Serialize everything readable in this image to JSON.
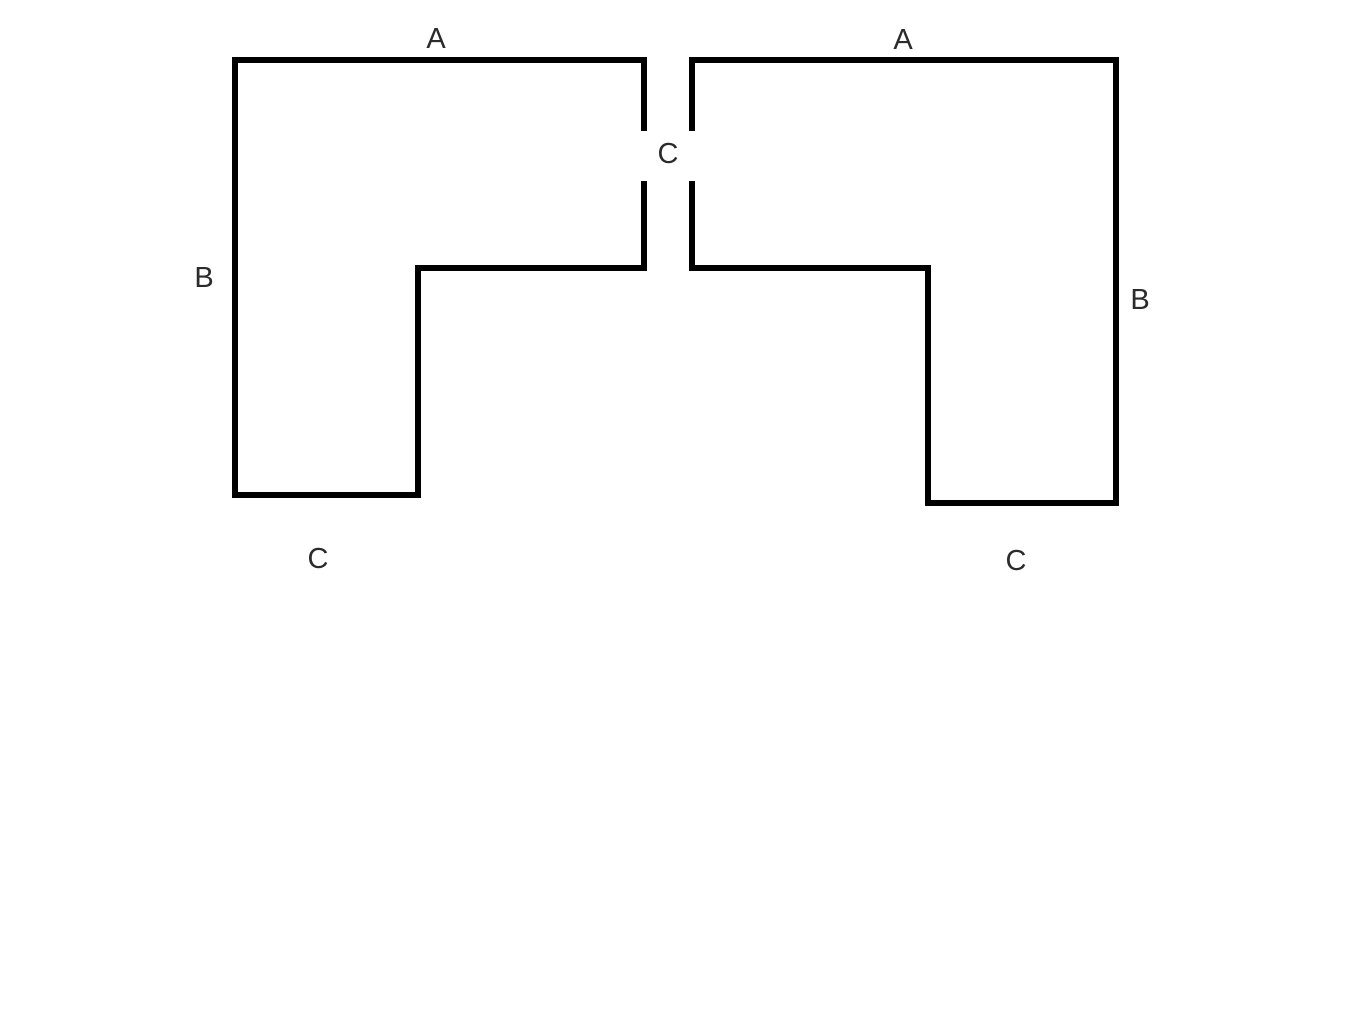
{
  "canvas": {
    "width": 1366,
    "height": 1025,
    "background": "#ffffff"
  },
  "style": {
    "stroke_color": "#000000",
    "stroke_width": 6,
    "label_color": "#2b2b2b",
    "label_font_size": 29
  },
  "shapes": [
    {
      "name": "left-l-shape",
      "points": [
        [
          644,
          131
        ],
        [
          644,
          60
        ],
        [
          235,
          60
        ],
        [
          235,
          495
        ],
        [
          418,
          495
        ],
        [
          418,
          268
        ],
        [
          644,
          268
        ],
        [
          644,
          181
        ]
      ]
    },
    {
      "name": "right-l-shape",
      "points": [
        [
          692,
          131
        ],
        [
          692,
          60
        ],
        [
          1116,
          60
        ],
        [
          1116,
          503
        ],
        [
          928,
          503
        ],
        [
          928,
          268
        ],
        [
          692,
          268
        ],
        [
          692,
          181
        ]
      ]
    }
  ],
  "labels": [
    {
      "name": "label-a-left",
      "text": "A",
      "x": 436,
      "y": 48
    },
    {
      "name": "label-a-right",
      "text": "A",
      "x": 903,
      "y": 49
    },
    {
      "name": "label-b-left",
      "text": "B",
      "x": 204,
      "y": 287
    },
    {
      "name": "label-b-right",
      "text": "B",
      "x": 1140,
      "y": 309
    },
    {
      "name": "label-c-center",
      "text": "C",
      "x": 668,
      "y": 163
    },
    {
      "name": "label-c-bottom-left",
      "text": "C",
      "x": 318,
      "y": 568
    },
    {
      "name": "label-c-bottom-right",
      "text": "C",
      "x": 1016,
      "y": 570
    }
  ]
}
